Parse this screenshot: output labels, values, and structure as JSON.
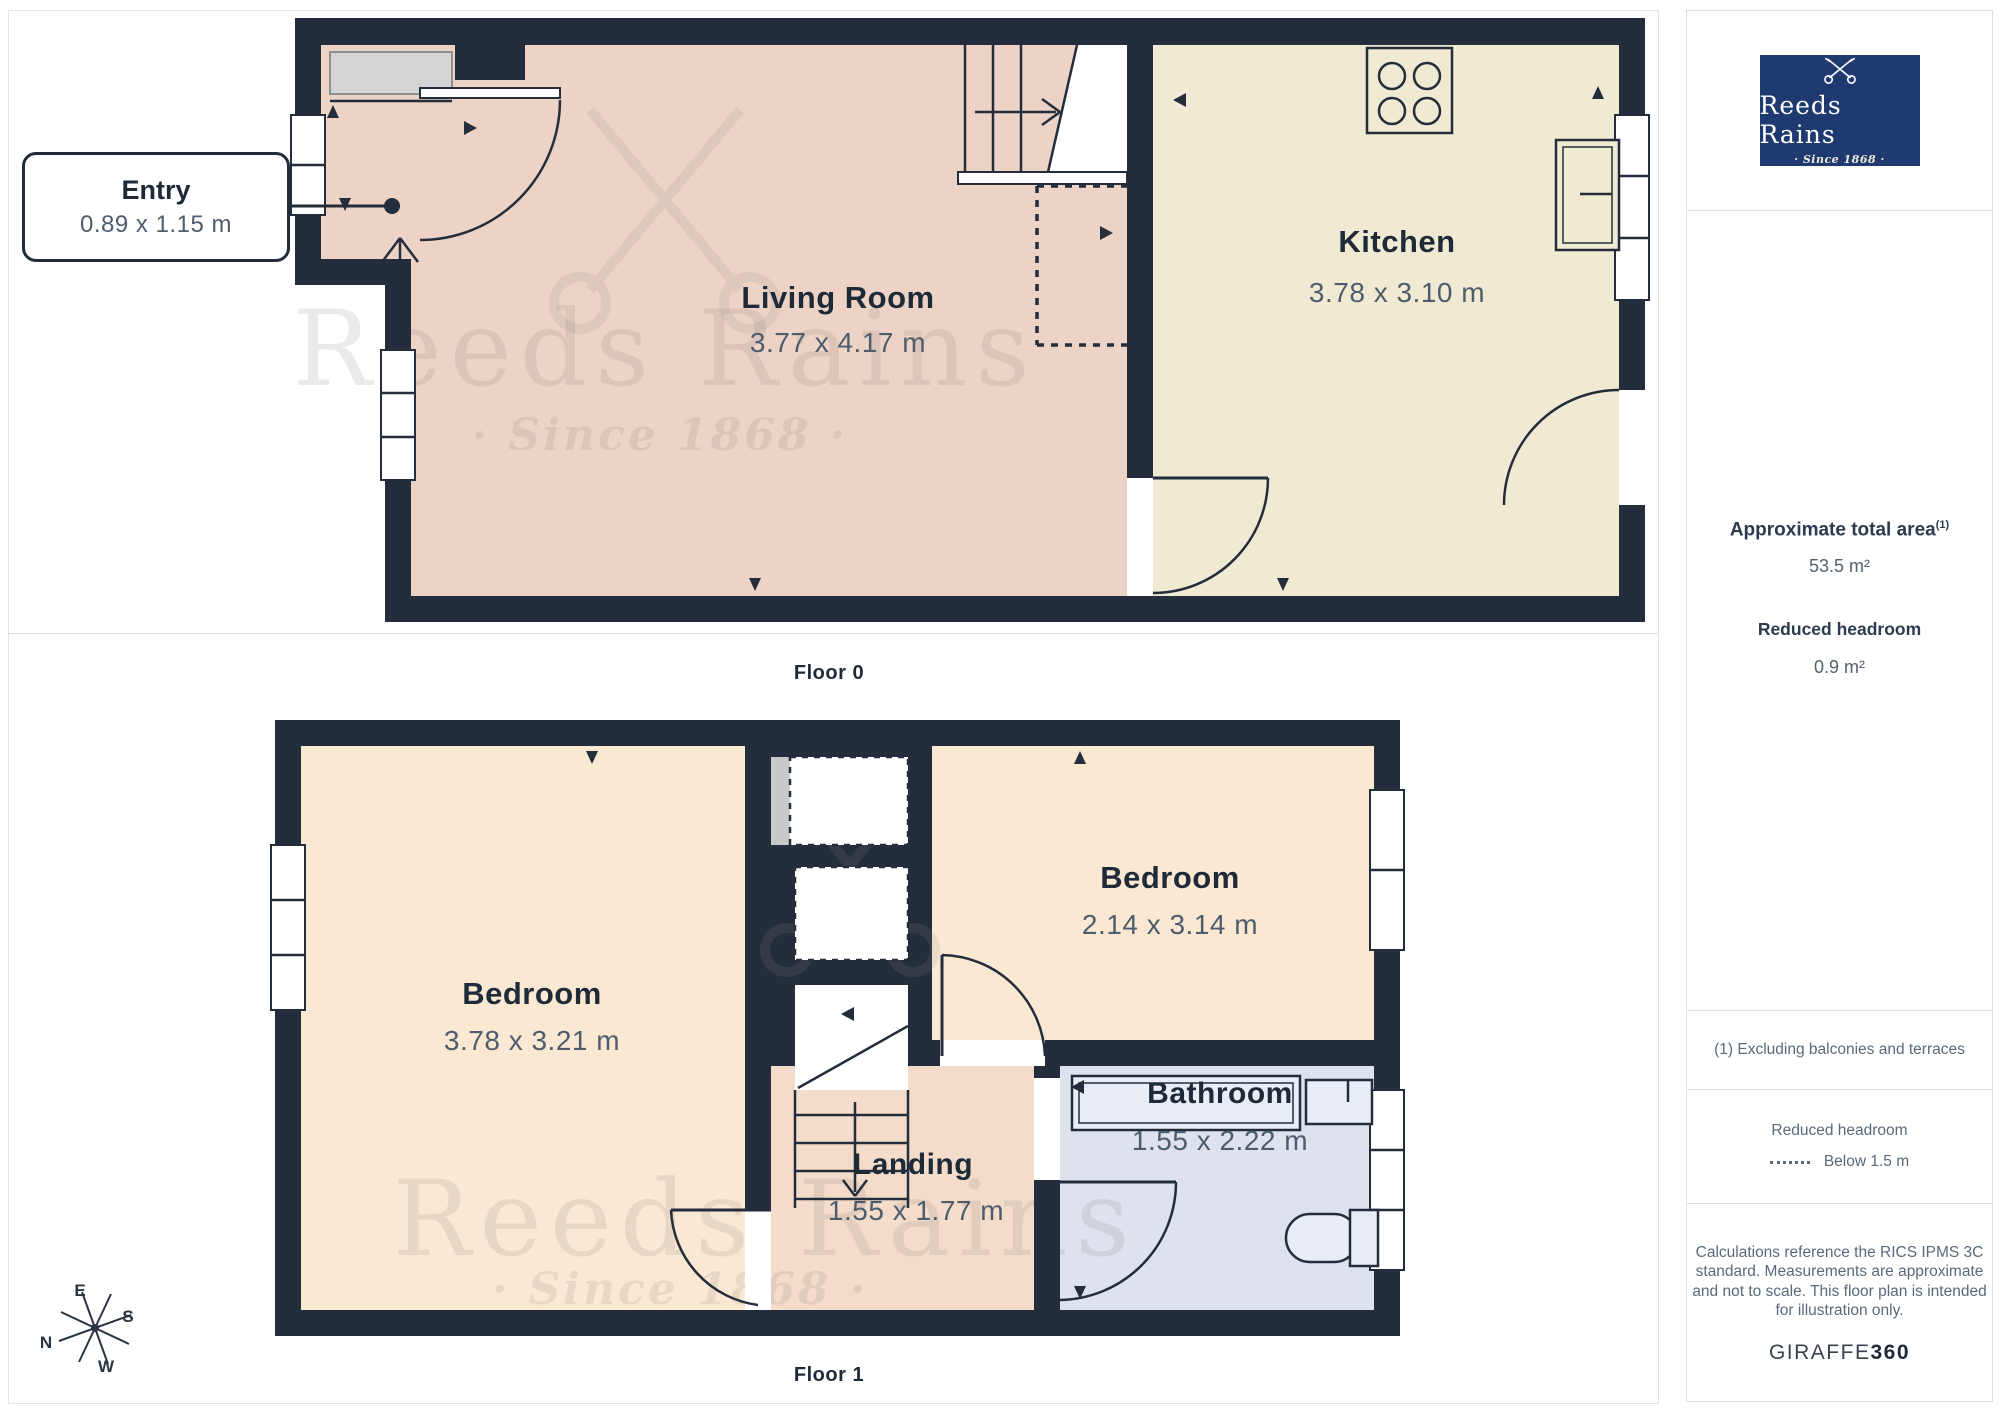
{
  "brand": {
    "name": "Reeds Rains",
    "tagline": "· Since 1868 ·"
  },
  "watermark": {
    "line1": "Reeds Rains",
    "line2": "· Since 1868 ·"
  },
  "floor0": {
    "caption": "Floor 0",
    "entry": {
      "name": "Entry",
      "dims": "0.89 x 1.15 m"
    },
    "living_room": {
      "name": "Living Room",
      "dims": "3.77 x 4.17 m"
    },
    "kitchen": {
      "name": "Kitchen",
      "dims": "3.78 x 3.10 m"
    }
  },
  "floor1": {
    "caption": "Floor 1",
    "bedroom_left": {
      "name": "Bedroom",
      "dims": "3.78 x 3.21 m"
    },
    "bedroom_right": {
      "name": "Bedroom",
      "dims": "2.14 x 3.14 m"
    },
    "bathroom": {
      "name": "Bathroom",
      "dims": "1.55 x 2.22 m"
    },
    "landing": {
      "name": "Landing",
      "dims": "1.55 x 1.77 m"
    }
  },
  "compass": {
    "n": "N",
    "e": "E",
    "s": "S",
    "w": "W"
  },
  "sidebar": {
    "area_title": "Approximate total area",
    "area_footnote_ref": "(1)",
    "area_value": "53.5 m²",
    "headroom_title": "Reduced headroom",
    "headroom_value": "0.9 m²",
    "footnote": "(1) Excluding balconies and terraces",
    "legend_title": "Reduced headroom",
    "legend_item": "Below 1.5 m",
    "disclaimer": "Calculations reference the RICS IPMS 3C standard. Measurements are approximate and not to scale. This floor plan is intended for illustration only.",
    "credit_normal": "GIRAFFE",
    "credit_bold": "360"
  },
  "colors": {
    "wall": "#232d3b",
    "living": "#edd3c5",
    "kitchen": "#f1ead3",
    "bedroom": "#fbe8d3",
    "landing": "#f4dcca",
    "bathroom": "#dde2ed",
    "brand_navy": "#1f3a70",
    "label": "#1f2a39",
    "dim_text": "#4e5d6e"
  }
}
